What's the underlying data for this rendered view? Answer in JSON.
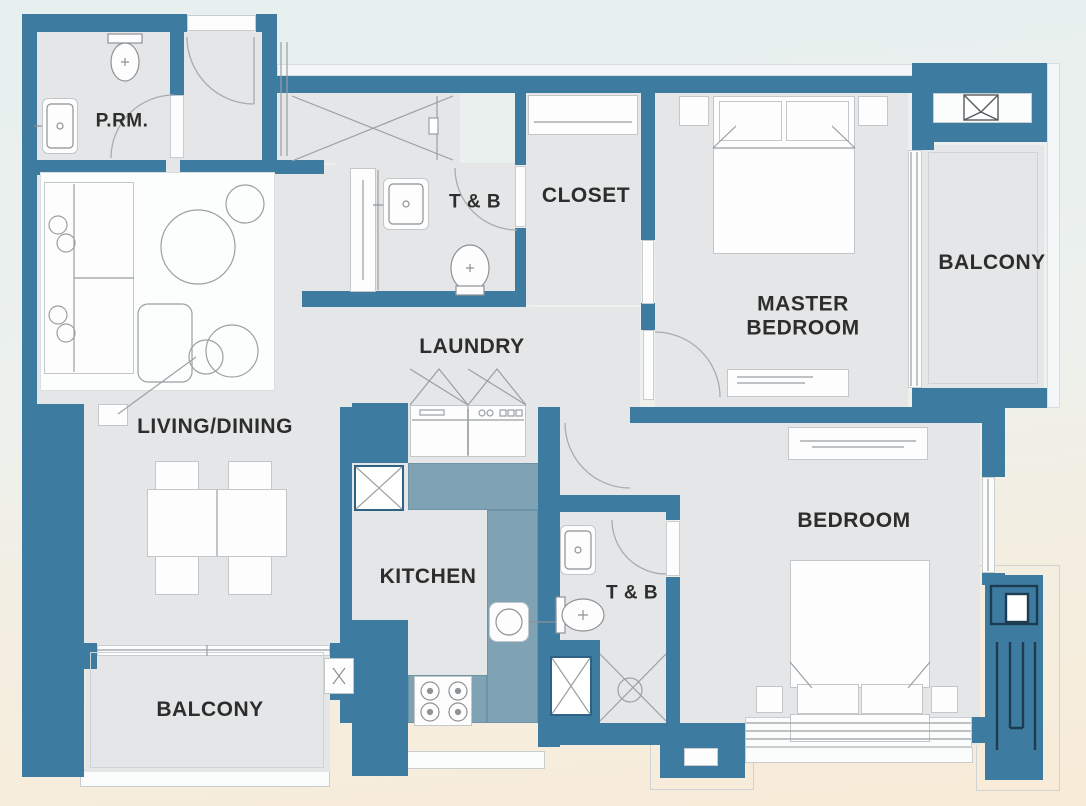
{
  "meta": {
    "type": "apartment-floor-plan",
    "width_px": 1086,
    "height_px": 806
  },
  "colors": {
    "wall": "#3d7ca0",
    "floor": "#e4e6e7",
    "counter": "#7fa3b5",
    "bg_top": "#e7efef",
    "bg_bottom": "#f8ecd8",
    "label_text": "#2d2d2d",
    "dark": "#1d3c51"
  },
  "labels": {
    "powder_room": "P.RM.",
    "toilet_bath_1": "T & B",
    "closet": "CLOSET",
    "master_bedroom_line1": "MASTER",
    "master_bedroom_line2": "BEDROOM",
    "balcony_right": "BALCONY",
    "living_dining": "LIVING/DINING",
    "laundry": "LAUNDRY",
    "kitchen": "KITCHEN",
    "toilet_bath_2": "T & B",
    "bedroom": "BEDROOM",
    "balcony_bottom": "BALCONY"
  }
}
